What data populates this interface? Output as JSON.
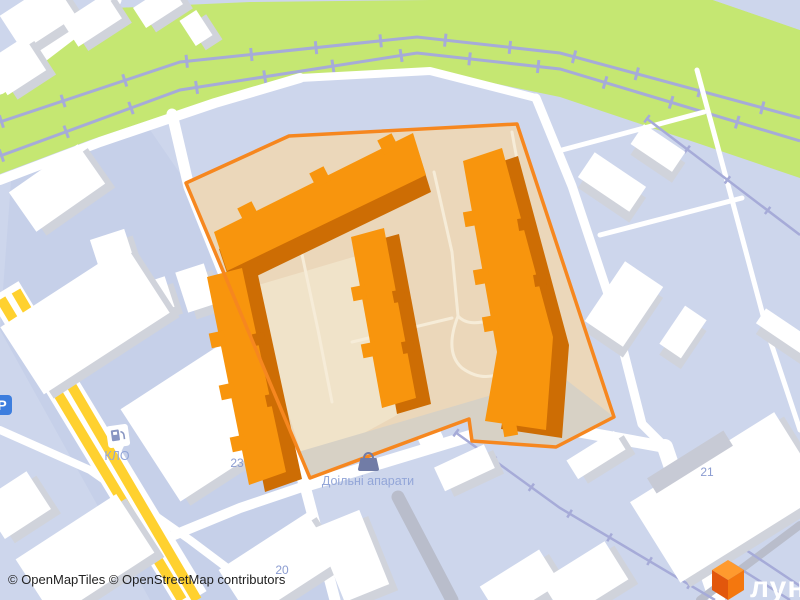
{
  "map": {
    "attribution": {
      "text": "© OpenMapTiles © OpenStreetMap contributors"
    },
    "poi": {
      "gas_station_label": "КЛО",
      "shop_label": "Доільні апарати",
      "parking_label": "P"
    },
    "house_numbers": {
      "n23": "23",
      "n20": "20",
      "n21": "21"
    },
    "logo": {
      "text": "лун",
      "cube_colors": {
        "top": "#ff9a2e",
        "left": "#e2570c",
        "right": "#f4770e"
      }
    },
    "colors": {
      "background": "#cdd6ec",
      "parcel": "#c6d0e9",
      "greenery": "#c5e772",
      "railway": "#a6abd8",
      "road": "#ffffff",
      "major_road_yellow": "#ffd12f",
      "highlight_outline": "#f6871f",
      "highlight_fill": "#ebd7ba",
      "highlight_parking": "#d7d1c5",
      "building_top_orange": "#f8950d",
      "building_side_orange": "#cd6d04",
      "building_white": "#ffffff",
      "building_shadow": "#d0d3db",
      "label_text": "#8b9cd1"
    },
    "icons": [
      "fuel-pump-icon",
      "shopping-bag-icon",
      "parking-icon",
      "cube-logo-icon"
    ]
  }
}
